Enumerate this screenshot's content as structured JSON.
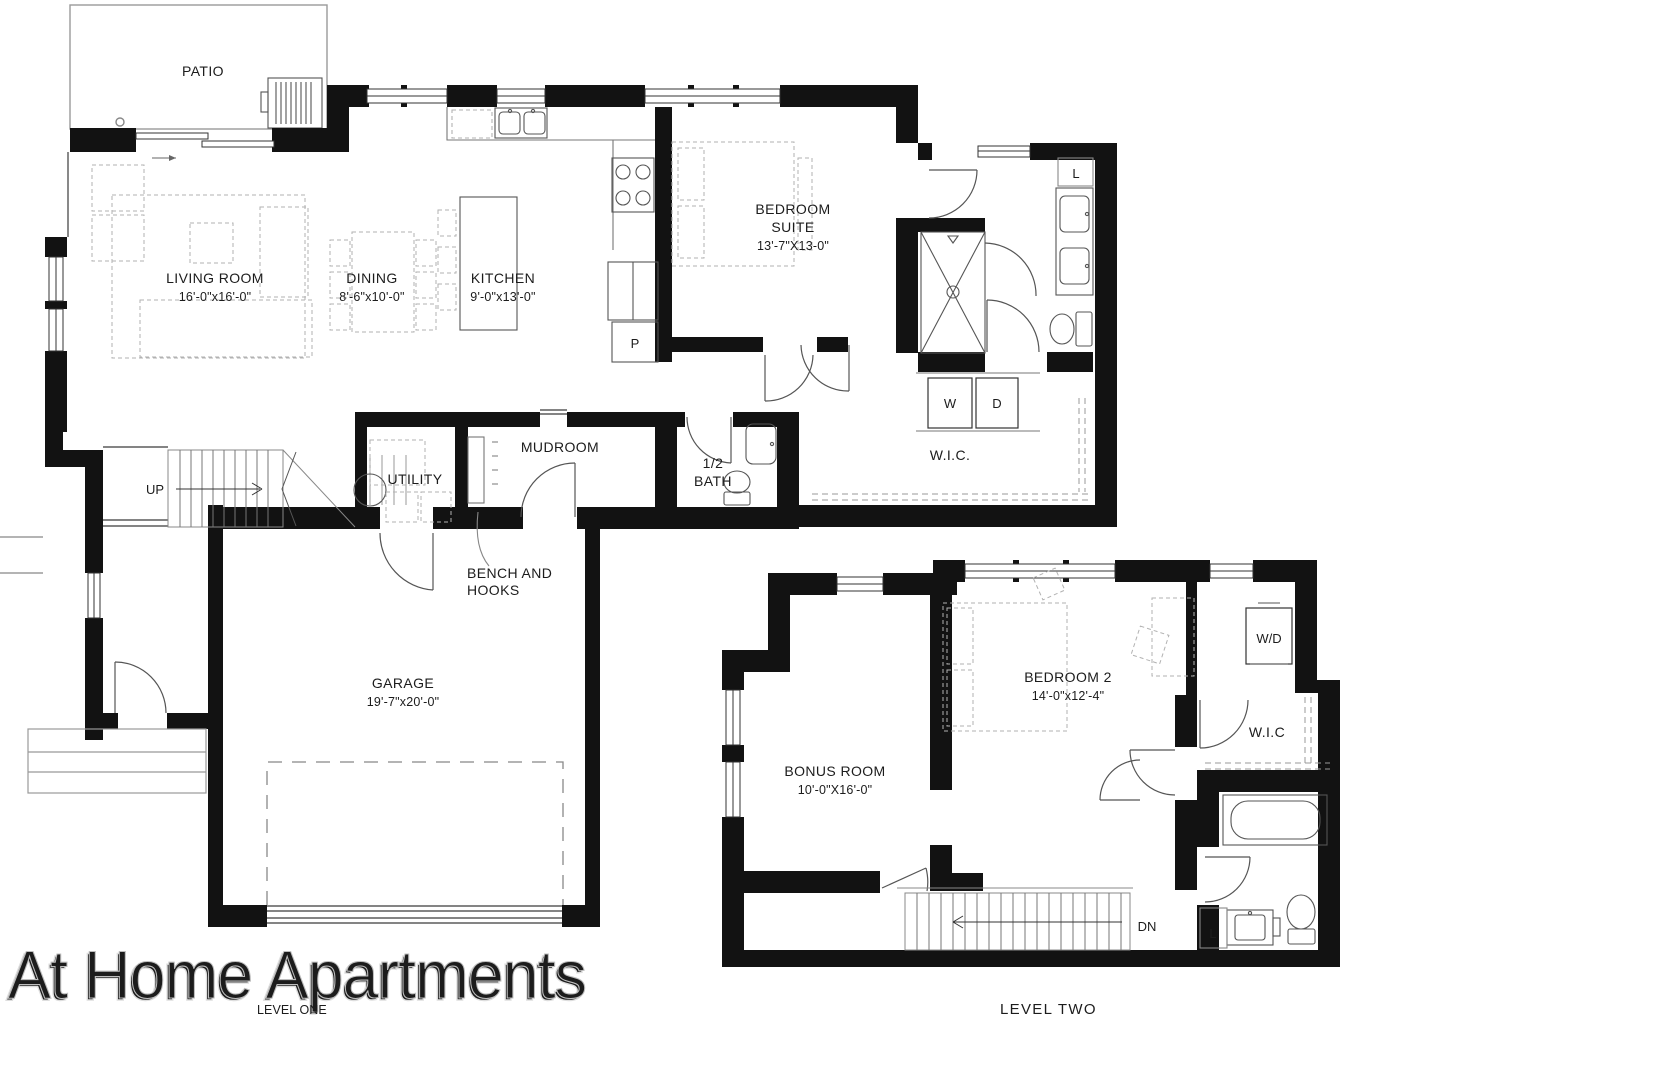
{
  "watermark": "At Home Apartments",
  "level_one": {
    "title": "LEVEL ONE",
    "patio": "PATIO",
    "living": {
      "name": "LIVING ROOM",
      "dims": "16'-0\"x16'-0\""
    },
    "dining": {
      "name": "DINING",
      "dims": "8'-6\"x10'-0\""
    },
    "kitchen": {
      "name": "KITCHEN",
      "dims": "9'-0\"x13'-0\""
    },
    "bedroom_suite": {
      "line1": "BEDROOM",
      "line2": "SUITE",
      "dims": "13'-7\"X13-0\""
    },
    "pantry": "P",
    "linen": "L",
    "mudroom": "MUDROOM",
    "utility": "UTILITY",
    "half_bath": {
      "line1": "1/2",
      "line2": "BATH"
    },
    "wic": "W.I.C.",
    "washer": "W",
    "dryer": "D",
    "up": "UP",
    "bench": {
      "line1": "BENCH AND",
      "line2": "HOOKS"
    },
    "garage": {
      "name": "GARAGE",
      "dims": "19'-7\"x20'-0\""
    }
  },
  "level_two": {
    "title": "LEVEL TWO",
    "bonus": {
      "name": "BONUS ROOM",
      "dims": "10'-0\"X16'-0\""
    },
    "bedroom2": {
      "name": "BEDROOM 2",
      "dims": "14'-0\"x12'-4\""
    },
    "wd": "W/D",
    "wic": "W.I.C",
    "dn": "DN",
    "linen": "L"
  },
  "colors": {
    "wall": "#121212",
    "fixture": "#555555",
    "furniture": "#b2b2b2",
    "watermark_fill": "#f4f4f4"
  }
}
